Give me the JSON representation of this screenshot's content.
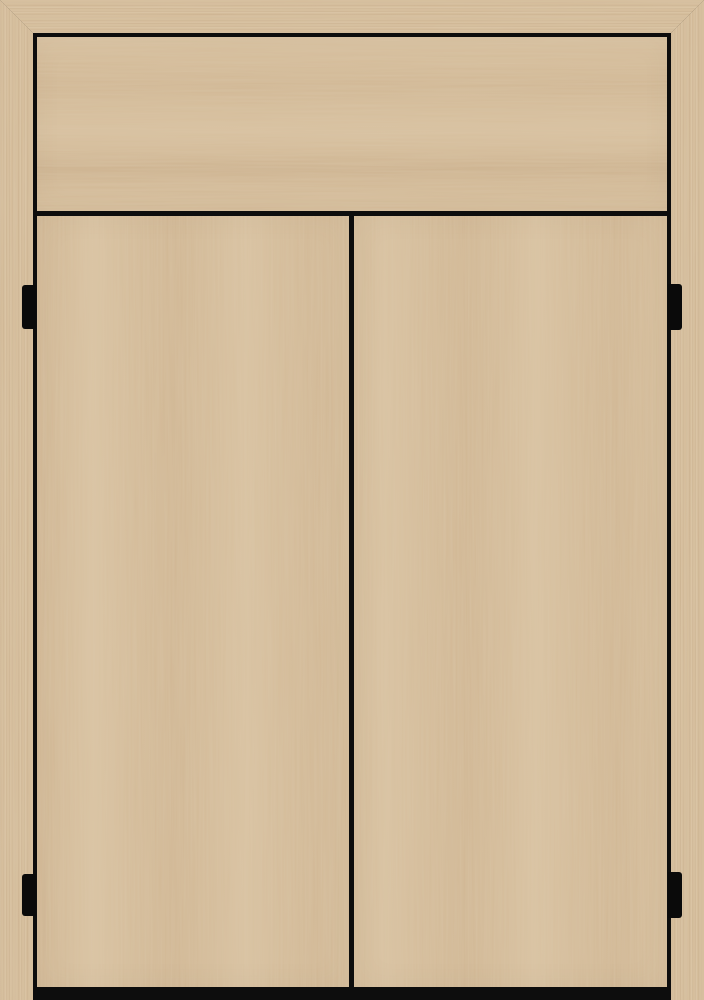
{
  "scene": {
    "title": "Wooden cabinet front",
    "description": "Light oak two-door cabinet front with an outer mitered wood frame, an upper fixed panel with horizontal grain, two vertical-grain doors, black reveal gaps, four black hinges and a dark base shadow"
  },
  "colors": {
    "wood_base": "#d5bd9b",
    "wood_light": "#e4d1b1",
    "wood_dark": "#c2a581",
    "wood_streak": "#b59368",
    "gap_black": "#0d0d0d",
    "hinge_black": "#0a0a0a"
  },
  "parts": {
    "frame_top": "frame top rail",
    "frame_left": "frame left stile",
    "frame_right": "frame right stile",
    "top_panel": "upper fixed panel",
    "left_door": "left door",
    "right_door": "right door",
    "hinge_top_left": "top left hinge",
    "hinge_bottom_left": "bottom left hinge",
    "hinge_top_right": "top right hinge",
    "hinge_bottom_right": "bottom right hinge",
    "base_shadow": "base shadow strip"
  }
}
